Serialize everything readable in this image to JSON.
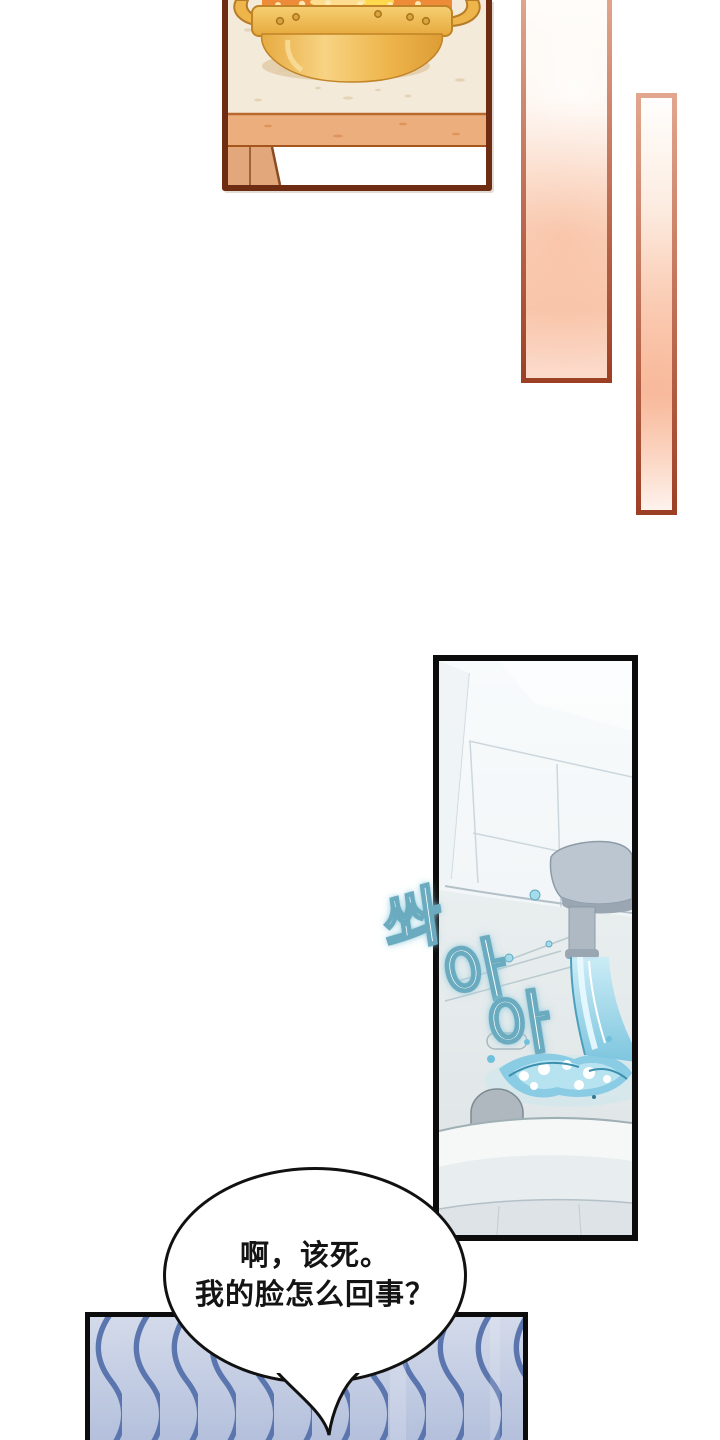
{
  "page": {
    "type": "webtoon-comic-page",
    "background_color": "#ffffff"
  },
  "kitchen_panel": {
    "description": "golden pot boiling on beige counter, wooden table edge and legs below",
    "border_color": "#6e2d12",
    "counter_color": "#f4ead9",
    "table_edge_color": "#ecae7d",
    "pot_color": "#eeb54b",
    "broth_color": "#ee8b38"
  },
  "accent_strips": {
    "count": 2,
    "border_top_color": "#e2a78f",
    "border_bottom_color": "#9c3f24",
    "fill_top_color": "#fffdf9",
    "fill_bottom_color": "#f9cab0"
  },
  "bathroom_panel": {
    "description": "bathroom sink with running faucet and splashing water",
    "border_color": "#0c0c0c",
    "wall_color": "#f2f6f8",
    "sink_color": "#e8edef",
    "faucet_color": "#bcc6d0",
    "water_color": "#74c2dd"
  },
  "sfx": {
    "text": "쏴아아",
    "chars": [
      "쏴",
      "아",
      "아"
    ],
    "fill_color": "#ffffff",
    "outline_color": "#6aabbf"
  },
  "bubble": {
    "lines": [
      "啊，该死。",
      "我的脸怎么回事？"
    ],
    "fill": "#ffffff",
    "stroke": "#111111",
    "text_color": "#141414"
  },
  "wave_panel": {
    "description": "blue wavy pattern panel, cut off at page bottom",
    "border_color": "#0c0c0c",
    "wave_color": "#5b76ae",
    "bg_top_color": "#d3daea",
    "bg_bottom_color": "#b4c0dc"
  }
}
